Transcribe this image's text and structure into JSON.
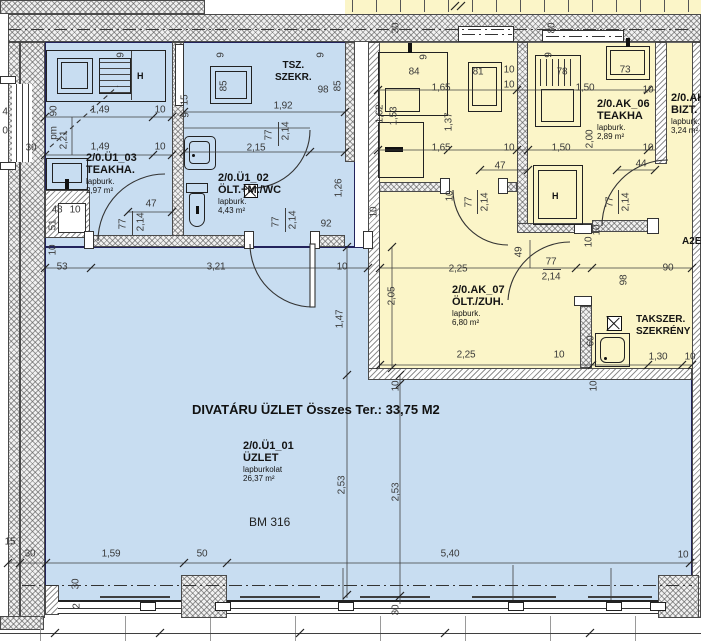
{
  "title": {
    "main": "DIVATÁRU ÜZLET Összes Ter.: 33,75 M2",
    "bm": "BM 316"
  },
  "rooms": [
    {
      "id": "2/0.Ü1_03",
      "name": "TEAKHA.",
      "finish": "lapburk.",
      "area": "2,97 m²"
    },
    {
      "id": "2/0.Ü1_02",
      "name": "ÖLT.+M./WC",
      "finish": "lapburk.",
      "area": "4,43 m²"
    },
    {
      "id": "2/0.Ü1_01",
      "name": "ÜZLET",
      "finish": "lapburkolat",
      "area": "26,37 m²"
    },
    {
      "id": "2/0.AK_06",
      "name": "TEAKHA",
      "finish": "lapburk.",
      "area": "2,89 m²"
    },
    {
      "id": "2/0.AK_07",
      "name": "ÖLT./ZUH.",
      "finish": "lapburk.",
      "area": "6,80 m²"
    },
    {
      "id": "2/0.AK",
      "name": "BIZT.",
      "finish": "lapburk.",
      "area": "3,24 m²"
    }
  ],
  "annotations": {
    "tsz1": "TSZ.",
    "tsz2": "SZEKR.",
    "takszer1": "TAKSZER.",
    "takszer2": "SZEKRÉNY",
    "a2e": "A2E",
    "h": "H"
  },
  "colors": {
    "room_blue": "#c8ddf1",
    "room_yellow": "#fbf5c8",
    "wall_line": "#23235c",
    "dim_text": "#3a3a3a"
  },
  "dims": [
    "1,49",
    "10",
    "1,49",
    "10",
    "1,92",
    "2,15",
    "98",
    "92",
    "53",
    "3,21",
    "10",
    "47",
    "48",
    "10",
    "1,65",
    "10",
    "10",
    "1,50",
    "10",
    "1,65",
    "10",
    "47",
    "1,50",
    "10",
    "44",
    "90",
    "2,25",
    "2,25",
    "10",
    "1,30",
    "10",
    "30",
    "1,59",
    "50",
    "5,40",
    "10",
    "30",
    "15",
    "77",
    "2,14",
    "90",
    "pm",
    "2,21",
    "2,14",
    "77",
    "2,14",
    "77",
    "2,14",
    "77",
    "1,26",
    "9",
    "9",
    "9",
    "9",
    "9",
    "85",
    "85",
    "15",
    "1,62",
    "1,53",
    "1,37",
    "2,00",
    "77",
    "2,14",
    "77",
    "2,14",
    "10",
    "2,05",
    "49",
    "10",
    "98",
    "60",
    "10",
    "1,47",
    "2,53",
    "2,53",
    "30",
    "80",
    "30",
    "2",
    "30",
    "10",
    "51",
    "10",
    "10",
    "9",
    "10",
    "84",
    "81",
    "78",
    "73",
    "4",
    "0"
  ]
}
